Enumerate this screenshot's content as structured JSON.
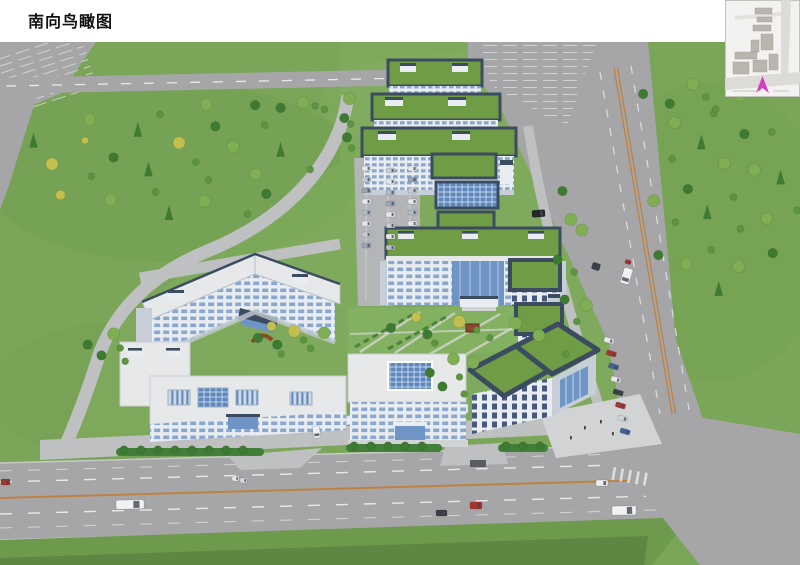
{
  "page": {
    "title": "南向鸟瞰图",
    "background": "#ffffff"
  },
  "colors": {
    "grass": "#7ba659",
    "grass_dark": "#6d9a4d",
    "lawn": "#84b061",
    "road": "#a6a6a8",
    "road_light": "#b4b5b7",
    "internal_road": "#bfc0c2",
    "marking_white": "#e9e9e9",
    "marking_orange": "#c08040",
    "wall": "#e9ecf0",
    "wall_shadow": "#c7ced8",
    "roof_white": "#e6e8ea",
    "roof_green": "#6f9c44",
    "parapet": "#3c4c60",
    "window_blue": "#8aa8cf",
    "window_dark": "#46597a",
    "glass": "#6e95c5",
    "glass_light": "#b3cbe4",
    "skylight": "#5d87bd",
    "tree": "#5d9440",
    "tree_dark": "#3f7a33",
    "tree_light": "#7fae53",
    "tree_yellow": "#c2bf4e",
    "hedge": "#42803a",
    "plaza": "#d2d3d5",
    "arrow": "#cf3fbf",
    "inset_bg": "#f3f2f0",
    "inset_building": "#b9b6b0",
    "inset_road": "#dddbd7"
  },
  "scene": {
    "tree_clusters": [
      {
        "name": "left-field",
        "cx": 175,
        "cy": 120,
        "rx": 150,
        "ry": 62,
        "n": 26,
        "pines": true,
        "yellow": true
      },
      {
        "name": "right-field",
        "cx": 722,
        "cy": 155,
        "rx": 80,
        "ry": 105,
        "n": 24,
        "pines": true,
        "yellow": false
      },
      {
        "name": "right-field-top",
        "cx": 690,
        "cy": 55,
        "rx": 55,
        "ry": 20,
        "n": 6,
        "pines": false,
        "yellow": false
      },
      {
        "name": "garden-south",
        "cx": 292,
        "cy": 298,
        "rx": 46,
        "ry": 16,
        "n": 8,
        "pines": false,
        "yellow": true
      },
      {
        "name": "top-road-row",
        "cx": 300,
        "cy": 64,
        "rx": 48,
        "ry": 5,
        "n": 5,
        "pines": false,
        "yellow": false
      },
      {
        "name": "slab-west-row",
        "cx": 349,
        "cy": 82,
        "rx": 5,
        "ry": 36,
        "n": 5,
        "pines": false,
        "yellow": false
      },
      {
        "name": "east-boundary-row",
        "cx": 570,
        "cy": 230,
        "rx": 18,
        "ry": 100,
        "n": 9,
        "pines": false,
        "yellow": false
      },
      {
        "name": "front-lawn-trees",
        "cx": 455,
        "cy": 288,
        "rx": 92,
        "ry": 16,
        "n": 9,
        "pines": false,
        "yellow": true
      },
      {
        "name": "entry-west",
        "cx": 112,
        "cy": 306,
        "rx": 26,
        "ry": 20,
        "n": 5,
        "pines": false,
        "yellow": false
      },
      {
        "name": "courtyard-west",
        "cx": 452,
        "cy": 335,
        "rx": 26,
        "ry": 28,
        "n": 6,
        "pines": false,
        "yellow": false
      }
    ],
    "hedges": [
      {
        "x": 116,
        "y": 406,
        "w": 148,
        "h": 8
      },
      {
        "x": 346,
        "y": 402,
        "w": 96,
        "h": 8
      },
      {
        "x": 498,
        "y": 402,
        "w": 50,
        "h": 8
      }
    ],
    "vehicles": [
      {
        "name": "bus",
        "x": 116,
        "y": 458,
        "w": 28,
        "h": 9,
        "c": "#f2f2f2",
        "a": -1
      },
      {
        "name": "bus",
        "x": 612,
        "y": 464,
        "w": 24,
        "h": 9,
        "c": "#f2f2f2",
        "a": -1
      },
      {
        "name": "car",
        "x": 1,
        "y": 437,
        "w": 9,
        "h": 6,
        "c": "#a83430",
        "a": 0
      },
      {
        "name": "car",
        "x": 232,
        "y": 434,
        "w": 7,
        "h": 5,
        "c": "#e8e8e8",
        "a": 0
      },
      {
        "name": "car",
        "x": 240,
        "y": 436,
        "w": 7,
        "h": 5,
        "c": "#d6d9dd",
        "a": 0
      },
      {
        "name": "car",
        "x": 436,
        "y": 468,
        "w": 11,
        "h": 6,
        "c": "#3a3f46",
        "a": 0
      },
      {
        "name": "car",
        "x": 470,
        "y": 460,
        "w": 12,
        "h": 7,
        "c": "#a83430",
        "a": 0
      },
      {
        "name": "car",
        "x": 596,
        "y": 438,
        "w": 12,
        "h": 6,
        "c": "#eceef0",
        "a": 0
      },
      {
        "name": "truck",
        "x": 622,
        "y": 226,
        "w": 9,
        "h": 16,
        "c": "#f0f0f0",
        "a": 18
      },
      {
        "name": "car",
        "x": 625,
        "y": 218,
        "w": 6,
        "h": 4,
        "c": "#a83430",
        "a": 18
      },
      {
        "name": "car",
        "x": 592,
        "y": 221,
        "w": 8,
        "h": 7,
        "c": "#3a3f46",
        "a": 18
      },
      {
        "name": "car",
        "x": 313,
        "y": 384,
        "w": 7,
        "h": 12,
        "c": "#f0f0f0",
        "a": -8
      },
      {
        "name": "car",
        "x": 532,
        "y": 168,
        "w": 13,
        "h": 7,
        "c": "#23262b",
        "a": -4
      }
    ],
    "parked_rows": [
      {
        "name": "west-lot-col-1",
        "x0": 362,
        "y0": 124,
        "dx": 0,
        "dy": 11,
        "n": 8,
        "w": 9,
        "h": 5,
        "a": 0,
        "colors": [
          "#e6e8ea",
          "#c6ccd4",
          "#9aa6b6",
          "#e6e8ea",
          "#b4bcc8"
        ]
      },
      {
        "name": "west-lot-col-2",
        "x0": 386,
        "y0": 126,
        "dx": 0,
        "dy": 11,
        "n": 8,
        "w": 9,
        "h": 5,
        "a": 0,
        "colors": [
          "#c6ccd4",
          "#e6e8ea",
          "#b4bcc8",
          "#9aa6b6",
          "#e6e8ea"
        ]
      },
      {
        "name": "west-lot-col-3",
        "x0": 408,
        "y0": 124,
        "dx": 0,
        "dy": 11,
        "n": 6,
        "w": 9,
        "h": 5,
        "a": 0,
        "colors": [
          "#e6e8ea",
          "#9aa6b6",
          "#c6ccd4",
          "#e6e8ea",
          "#b4bcc8"
        ]
      },
      {
        "name": "east-roadside",
        "x0": 604,
        "y0": 296,
        "dx": 2.3,
        "dy": 13,
        "n": 8,
        "w": 10,
        "h": 5,
        "a": 16,
        "colors": [
          "#e8eaec",
          "#a83430",
          "#44629a",
          "#e8eaec",
          "#3a3f46",
          "#a83430",
          "#d0d4d8",
          "#44629a"
        ]
      }
    ]
  }
}
